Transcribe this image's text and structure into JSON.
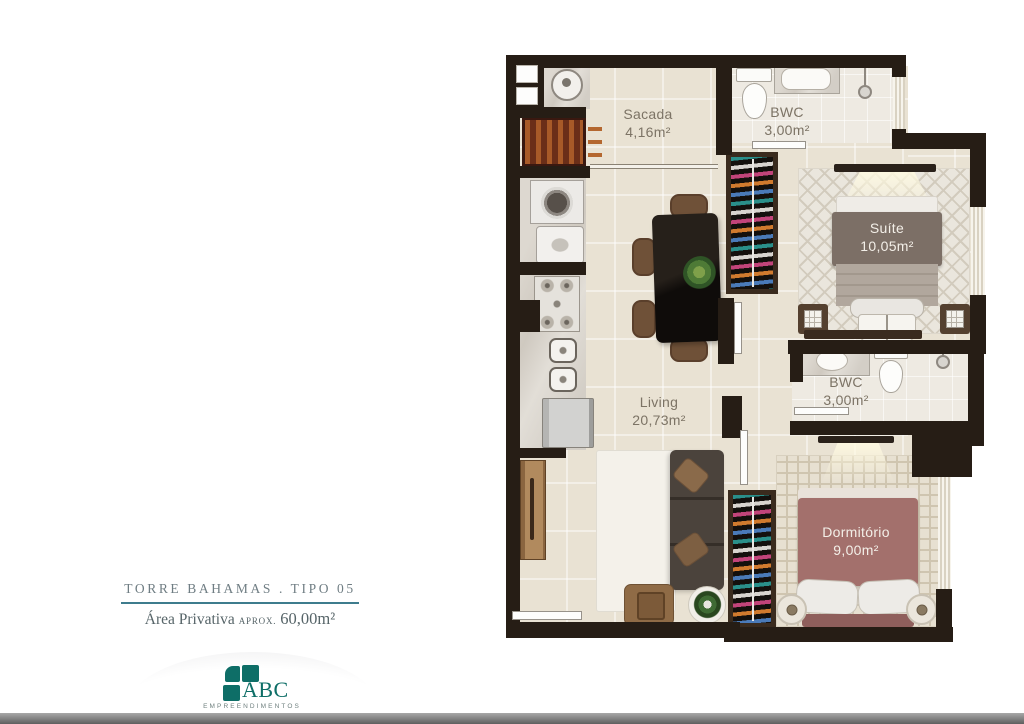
{
  "plan": {
    "rooms": [
      {
        "name": "Sacada",
        "area": "4,16m²"
      },
      {
        "name": "BWC",
        "area": "3,00m²"
      },
      {
        "name": "Suíte",
        "area": "10,05m²"
      },
      {
        "name": "Living",
        "area": "20,73m²"
      },
      {
        "name": "BWC",
        "area": "3,00m²"
      },
      {
        "name": "Dormitório",
        "area": "9,00m²"
      }
    ]
  },
  "footer": {
    "title": "TORRE BAHAMAS . TIPO 05",
    "area_label": "Área Privativa",
    "area_qualifier": "APROX.",
    "area_value": "60,00m²"
  },
  "logo": {
    "name": "ABC",
    "subtitle": "EMPREENDIMENTOS"
  },
  "colors": {
    "accent_teal_line": "#3e7c8d",
    "logo_teal": "#0e6e67",
    "wall": "#261d15",
    "floor_beige": "#e9e2d3",
    "footer_text": "#6f7d83"
  }
}
